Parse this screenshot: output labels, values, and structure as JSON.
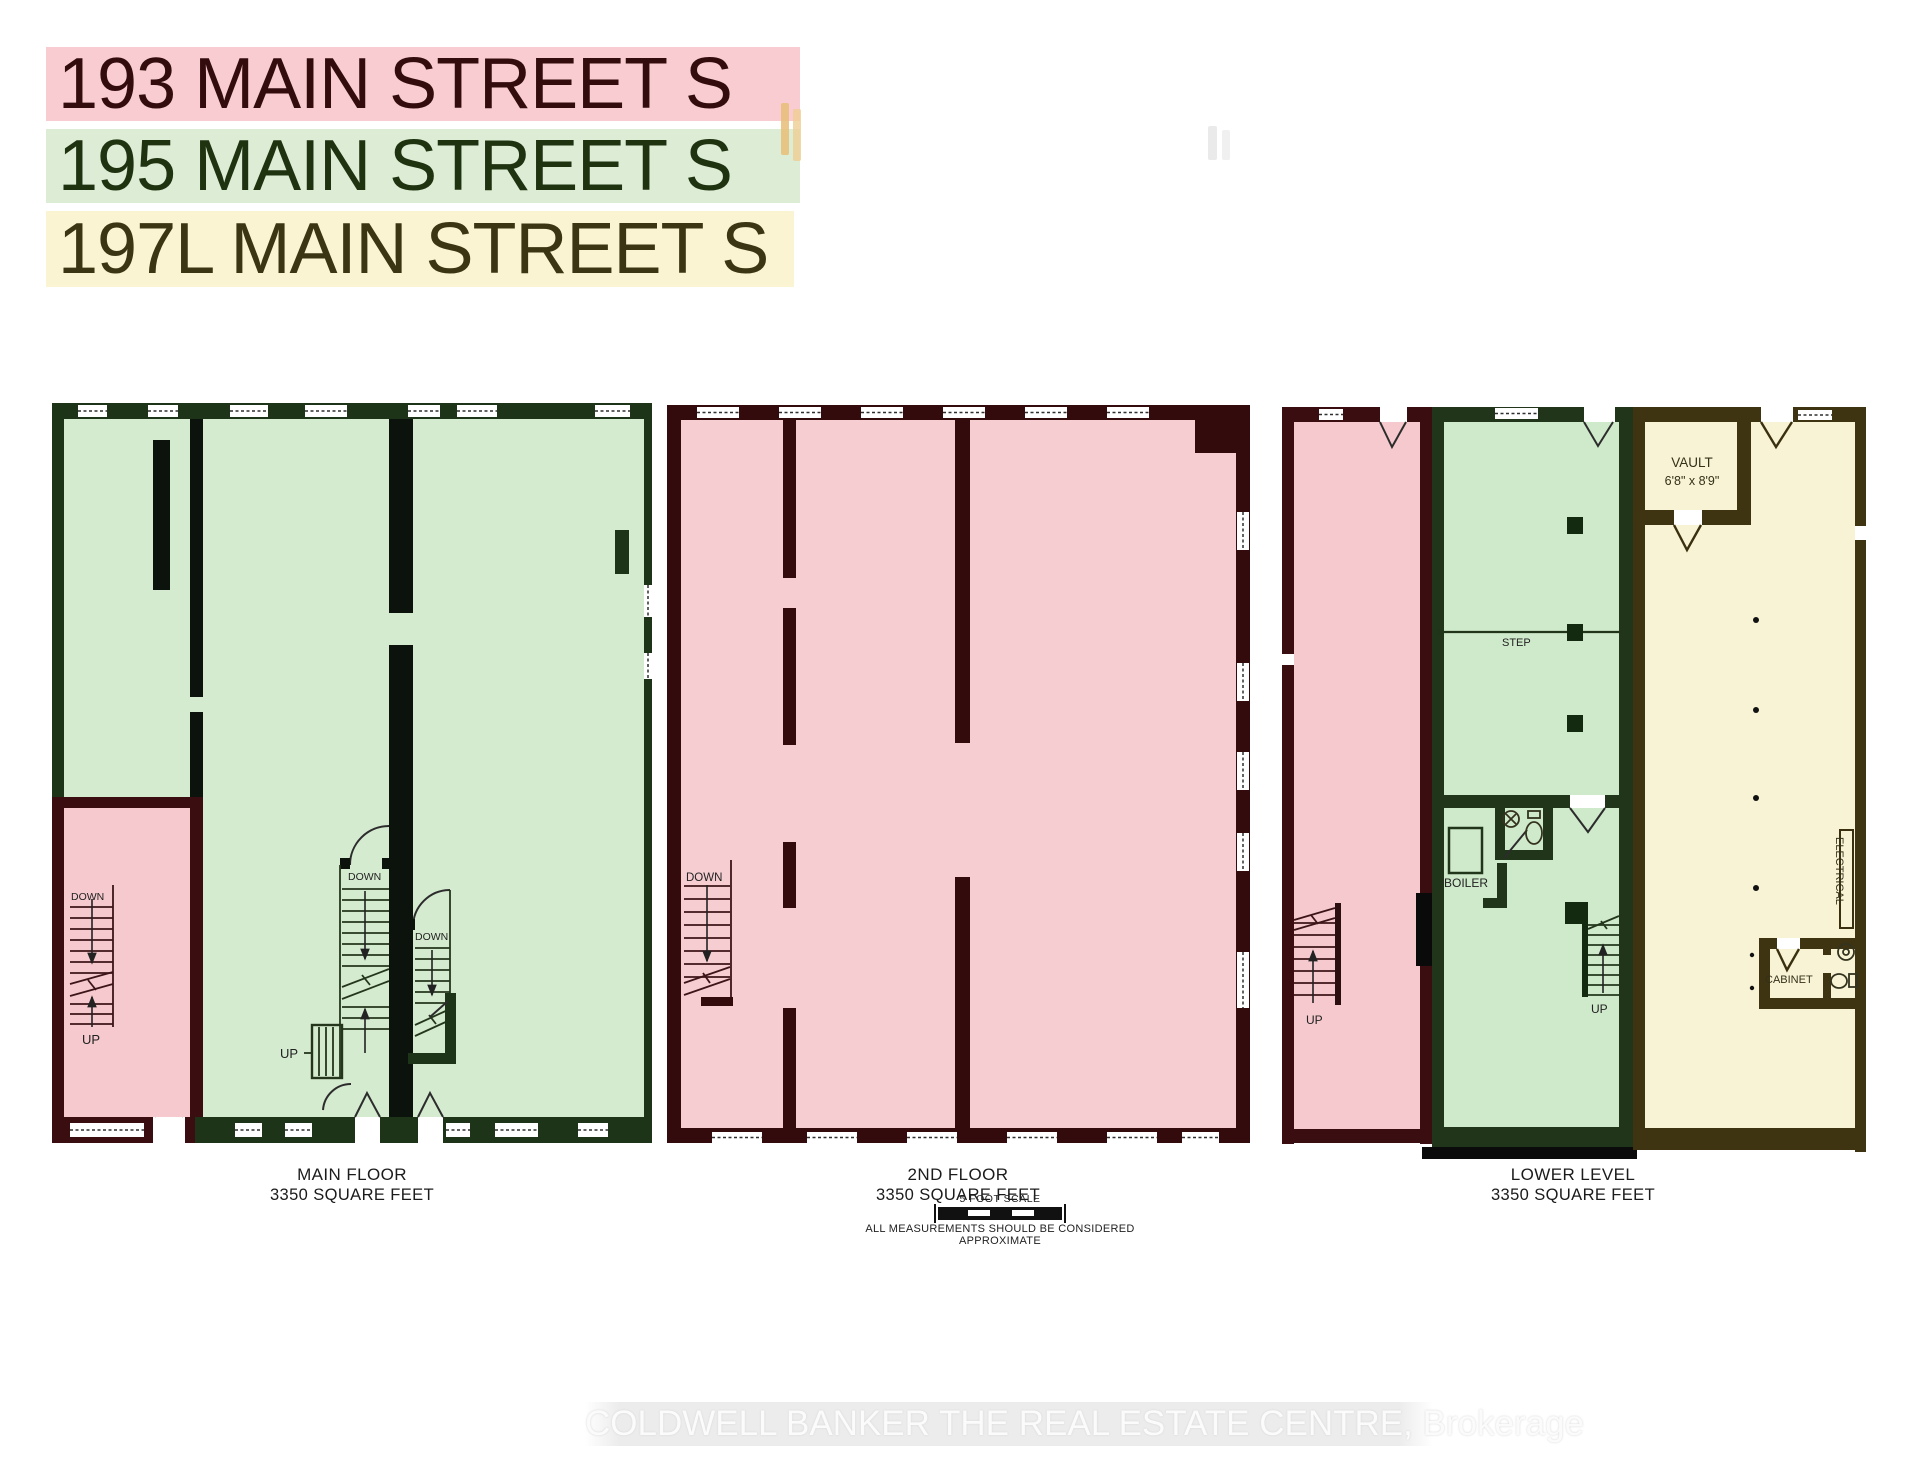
{
  "header": {
    "addresses": [
      {
        "label": "193 MAIN STREET S",
        "bg": "#f8ccd0",
        "color": "#330c0e"
      },
      {
        "label": "195 MAIN STREET S",
        "bg": "#ddedd5",
        "color": "#203311"
      },
      {
        "label": "197L MAIN STREET S",
        "bg": "#fbf4d3",
        "color": "#3b3513"
      }
    ]
  },
  "plans": [
    {
      "title": "MAIN FLOOR",
      "area": "3350 SQUARE FEET",
      "annotations": {
        "down_room": "DOWN",
        "up_room": "UP",
        "down_stair_left": "DOWN",
        "down_stair_right": "DOWN",
        "up_stair": "UP"
      }
    },
    {
      "title": "2ND FLOOR",
      "area": "3350 SQUARE FEET",
      "annotations": {
        "down_stair": "DOWN"
      }
    },
    {
      "title": "LOWER LEVEL",
      "area": "3350 SQUARE FEET",
      "annotations": {
        "up_stair_pink": "UP",
        "step": "STEP",
        "boiler": "BOILER",
        "up_stair_green": "UP",
        "vault": "VAULT",
        "vault_size": "6'8\" x 8'9\"",
        "electrical": "ELECTRICAL",
        "cabinet": "CABINET"
      }
    }
  ],
  "scale_note": {
    "title": "5 FOOT SCALE",
    "caption": "ALL MEASUREMENTS SHOULD BE CONSIDERED APPROXIMATE"
  },
  "watermark": "COLDWELL BANKER THE REAL ESTATE CENTRE, Brokerage",
  "colors": {
    "unit_193_pink": "#f8ccd0",
    "unit_195_green": "#ddedd5",
    "unit_197L_yellow": "#fbf4d3",
    "plan_pink_fill": "#f5c9cd",
    "plan_green_fill": "#d5ebd0",
    "plan_yellow_fill": "#f8f3d4",
    "maroon_wall": "#3a0d10",
    "green_wall": "#1e3418",
    "olive_wall": "#3e3412"
  }
}
